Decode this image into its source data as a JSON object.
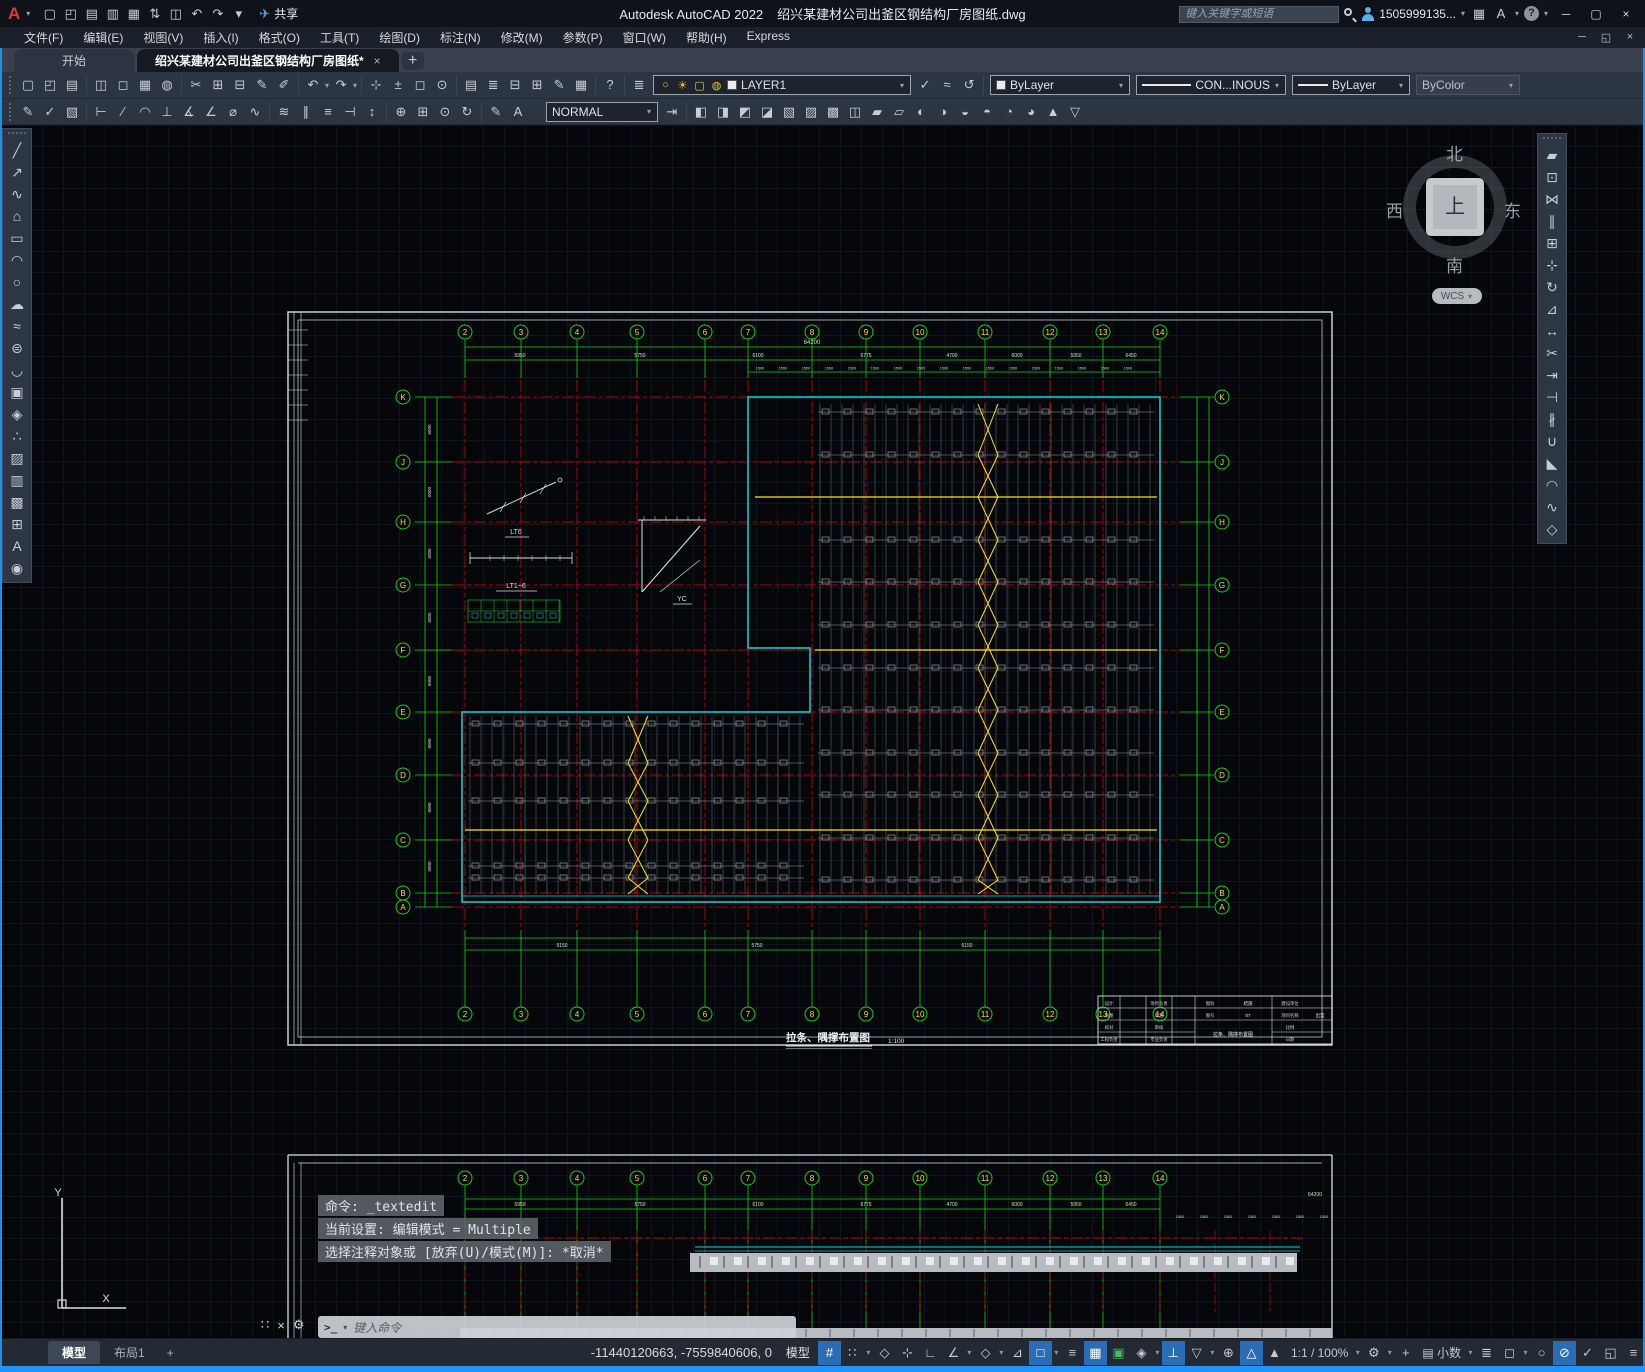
{
  "window": {
    "app_title": "Autodesk AutoCAD 2022",
    "doc_title": "绍兴某建材公司出釜区钢结构厂房图纸.dwg",
    "share_label": "共享",
    "search_placeholder": "键入关键字或短语",
    "account": "1505999135...",
    "help": "?"
  },
  "menu_items": [
    "文件(F)",
    "编辑(E)",
    "视图(V)",
    "插入(I)",
    "格式(O)",
    "工具(T)",
    "绘图(D)",
    "标注(N)",
    "修改(M)",
    "参数(P)",
    "窗口(W)",
    "帮助(H)",
    "Express"
  ],
  "file_tabs": {
    "start": "开始",
    "doc": "绍兴某建材公司出釜区钢结构厂房图纸*",
    "close": "×",
    "new_tab": "+"
  },
  "controls": {
    "layer": "LAYER1",
    "color": "ByLayer",
    "linetype": "CON...INOUS",
    "lineweight": "ByLayer",
    "plot_style": "ByColor",
    "dim_style": "NORMAL"
  },
  "qat_icons": [
    [
      "new-file",
      "▢"
    ],
    [
      "open-file",
      "◰"
    ],
    [
      "save",
      "▤"
    ],
    [
      "save-as",
      "▥"
    ],
    [
      "batch-plot",
      "▦"
    ],
    [
      "transfer",
      "⇅"
    ],
    [
      "print",
      "◫"
    ],
    [
      "undo",
      "↶"
    ],
    [
      "redo",
      "↷"
    ],
    [
      "customize",
      "▾"
    ]
  ],
  "toolbar1": [
    [
      [
        "new",
        "▢"
      ],
      [
        "open",
        "◰"
      ],
      [
        "save",
        "▤"
      ]
    ],
    [
      [
        "plot",
        "◫"
      ],
      [
        "plot-preview",
        "◻"
      ],
      [
        "publish",
        "▦"
      ],
      [
        "etransmit",
        "◍"
      ]
    ],
    [
      [
        "cut",
        "✂"
      ],
      [
        "copy-clip",
        "⊞"
      ],
      [
        "paste",
        "⊟"
      ],
      [
        "match-properties",
        "✎"
      ],
      [
        "block-editor",
        "✐"
      ]
    ],
    [
      [
        "undo",
        "↶",
        1
      ],
      [
        "redo",
        "↷",
        1
      ]
    ],
    [
      [
        "pan",
        "⊹"
      ],
      [
        "zoom-realtime",
        "±"
      ],
      [
        "zoom-window",
        "◻"
      ],
      [
        "zoom-previous",
        "⊙"
      ]
    ],
    [
      [
        "properties",
        "▤"
      ],
      [
        "layer-properties",
        "≣"
      ],
      [
        "tool-palettes",
        "⊟"
      ],
      [
        "sheet-set-manager",
        "⊞"
      ],
      [
        "markup",
        "✎"
      ],
      [
        "quick-calc",
        "▦"
      ]
    ],
    [
      [
        "help",
        "?"
      ]
    ]
  ],
  "layer_cluster": {
    "states_icon": [
      "layer-states",
      "≣"
    ],
    "combo_icons": [
      [
        "layer-on",
        "○"
      ],
      [
        "layer-sun",
        "☀"
      ],
      [
        "layer-frame",
        "▢"
      ],
      [
        "layer-lock",
        "◍"
      ]
    ],
    "after_icons": [
      [
        "make-current",
        "✓"
      ],
      [
        "match-layer",
        "≈"
      ],
      [
        "layer-previous",
        "↺"
      ]
    ]
  },
  "toolbar2a": [
    [
      [
        "edit-text",
        "✎"
      ],
      [
        "spell-check",
        "✓"
      ],
      [
        "annotation-monitor",
        "▧"
      ]
    ],
    [
      [
        "dim-linear",
        "⊢"
      ],
      [
        "dim-aligned",
        "∕"
      ],
      [
        "dim-arc-length",
        "◠"
      ],
      [
        "dim-ordinate",
        "⊥"
      ],
      [
        "dim-radius",
        "∡"
      ],
      [
        "dim-angular",
        "∠"
      ],
      [
        "dim-diameter",
        "⌀"
      ],
      [
        "dim-jogged",
        "∿"
      ]
    ],
    [
      [
        "dim-quick",
        "≋"
      ],
      [
        "dim-continue",
        "∥"
      ],
      [
        "dim-baseline",
        "≡"
      ],
      [
        "dim-break",
        "⊣"
      ],
      [
        "dim-adjust",
        "↕"
      ]
    ],
    [
      [
        "dim-center-mark",
        "⊕"
      ],
      [
        "tolerance",
        "⊞"
      ],
      [
        "dim-inspect",
        "⊙"
      ],
      [
        "dim-update",
        "↻"
      ]
    ],
    [
      [
        "dim-edit",
        "✎"
      ],
      [
        "dim-text-edit",
        "A"
      ]
    ]
  ],
  "toolbar2b": [
    [
      [
        "make-object-layer-current",
        "◧"
      ],
      [
        "layer-walk",
        "◨"
      ],
      [
        "layer-match",
        "◩"
      ],
      [
        "change-to-current-layer",
        "◪"
      ],
      [
        "layer-isolate",
        "▧"
      ],
      [
        "layer-unisolate",
        "▨"
      ],
      [
        "copy-to-new-layer",
        "▩"
      ],
      [
        "layer-freeze",
        "◫"
      ],
      [
        "layer-off",
        "▰"
      ],
      [
        "layer-on-all",
        "▱"
      ],
      [
        "layer-lock2",
        "◐"
      ],
      [
        "layer-unlock",
        "◑"
      ],
      [
        "layer-thaw-all",
        "◒"
      ],
      [
        "layer-merge",
        "◓"
      ],
      [
        "layer-delete",
        "◔"
      ],
      [
        "layer-combine",
        "◕"
      ],
      [
        "layer-up",
        "▲"
      ],
      [
        "layer-down",
        "▽"
      ]
    ]
  ],
  "draw_toolbar": [
    [
      "line",
      "╱"
    ],
    [
      "construction-line",
      "↗"
    ],
    [
      "polyline",
      "∿"
    ],
    [
      "polygon",
      "⌂"
    ],
    [
      "rectangle",
      "▭"
    ],
    [
      "arc",
      "◠"
    ],
    [
      "circle",
      "○"
    ],
    [
      "revision-cloud",
      "☁"
    ],
    [
      "spline",
      "≈"
    ],
    [
      "ellipse",
      "⊜"
    ],
    [
      "ellipse-arc",
      "◡"
    ],
    [
      "insert-block",
      "▣"
    ],
    [
      "create-block",
      "◈"
    ],
    [
      "point",
      "∴"
    ],
    [
      "hatch",
      "▨"
    ],
    [
      "gradient",
      "▥"
    ],
    [
      "region",
      "▩"
    ],
    [
      "table",
      "⊞"
    ],
    [
      "mtext",
      "A"
    ],
    [
      "point-style",
      "◉"
    ]
  ],
  "modify_toolbar": [
    [
      "erase",
      "▰"
    ],
    [
      "copy",
      "⊡"
    ],
    [
      "mirror",
      "⋈"
    ],
    [
      "offset",
      "∥"
    ],
    [
      "array",
      "⊞"
    ],
    [
      "move",
      "⊹"
    ],
    [
      "rotate",
      "↻"
    ],
    [
      "scale",
      "⊿"
    ],
    [
      "stretch",
      "↔"
    ],
    [
      "trim",
      "✂"
    ],
    [
      "extend",
      "⇥"
    ],
    [
      "break-at-point",
      "⊣"
    ],
    [
      "break",
      "∦"
    ],
    [
      "join",
      "∪"
    ],
    [
      "chamfer",
      "◣"
    ],
    [
      "fillet",
      "◠"
    ],
    [
      "blend-curves",
      "∿"
    ],
    [
      "explode",
      "◇"
    ]
  ],
  "viewcube": {
    "north": "北",
    "south": "南",
    "west": "西",
    "east": "东",
    "top": "上",
    "wcs": "WCS"
  },
  "command": {
    "lines": [
      "命令: _textedit",
      "当前设置: 编辑模式 = Multiple",
      "选择注释对象或 [放弃(U)/模式(M)]: *取消*"
    ],
    "input_placeholder": "键入命令"
  },
  "statusbar": {
    "coords": "-11440120663, -7559840606, 0",
    "model_btn": "模型",
    "annotation_scale": "1:1 / 100%",
    "units": "小数"
  },
  "status_toggles": [
    [
      "grid",
      "#",
      true,
      false,
      ""
    ],
    [
      "snap",
      "∷",
      false,
      true,
      ""
    ],
    [
      "infer-constraints",
      "◇",
      false,
      false,
      ""
    ],
    [
      "dynamic-input",
      "⊹",
      false,
      false,
      ""
    ],
    [
      "ortho",
      "∟",
      false,
      false,
      ""
    ],
    [
      "polar-tracking",
      "∠",
      false,
      true,
      ""
    ],
    [
      "isometric-drafting",
      "◇",
      false,
      true,
      ""
    ],
    [
      "object-snap-tracking",
      "⊿",
      false,
      false,
      ""
    ],
    [
      "object-snap",
      "□",
      true,
      true,
      ""
    ],
    [
      "lineweight-display",
      "≡",
      false,
      false,
      ""
    ],
    [
      "transparency",
      "▦",
      true,
      false,
      ""
    ],
    [
      "selection-cycling",
      "▣",
      false,
      false,
      "green"
    ],
    [
      "3d-object-snap",
      "◈",
      false,
      true,
      ""
    ],
    [
      "dynamic-ucs",
      "⊥",
      true,
      false,
      ""
    ],
    [
      "selection-filtering",
      "▽",
      false,
      true,
      ""
    ],
    [
      "gizmo",
      "⊕",
      false,
      false,
      ""
    ],
    [
      "annotation-visibility",
      "△",
      true,
      false,
      ""
    ],
    [
      "autoscale",
      "▲",
      false,
      false,
      ""
    ],
    [
      "annotation-scale",
      "1:1 / 100%",
      false,
      true,
      "text"
    ],
    [
      "workspace-switching",
      "⚙",
      false,
      true,
      ""
    ],
    [
      "isolate",
      "+",
      false,
      false,
      ""
    ],
    [
      "units",
      "小数",
      false,
      true,
      "units"
    ],
    [
      "quick-properties",
      "≣",
      false,
      false,
      ""
    ],
    [
      "lock-ui",
      "◻",
      false,
      true,
      ""
    ],
    [
      "isolate-objects",
      "○",
      false,
      false,
      ""
    ],
    [
      "hardware-acceleration",
      "⊘",
      true,
      false,
      ""
    ],
    [
      "trusted-autodesk",
      "✓",
      false,
      false,
      ""
    ],
    [
      "clean-screen",
      "◱",
      false,
      false,
      ""
    ],
    [
      "customization-menu",
      "≡",
      false,
      false,
      ""
    ]
  ],
  "model_tabs": {
    "model": "模型",
    "layout1": "布局1",
    "add": "+"
  },
  "drawing": {
    "title": "拉条、隅撑布置图",
    "scale_note": "1:100",
    "top_axes": [
      "2",
      "3",
      "4",
      "5",
      "6",
      "7",
      "8",
      "9",
      "10",
      "11",
      "12",
      "13",
      "14"
    ],
    "bottom_axes": [
      "2",
      "3",
      "4",
      "5",
      "6",
      "7",
      "8",
      "9",
      "10",
      "11",
      "12",
      "13",
      "14"
    ],
    "row_axes": [
      "K",
      "J",
      "H",
      "G",
      "F",
      "E",
      "D",
      "C",
      "B",
      "A"
    ],
    "top_overall_dim": "64200",
    "top_dims": [
      "5950",
      "5750",
      "6100",
      "6775",
      "4700",
      "6000",
      "5950",
      "6450"
    ],
    "spacing_dim": "1500",
    "bottom_dims": [
      "9150",
      "5750",
      "6150"
    ],
    "side_dims": [
      "6000",
      "6000",
      "6000",
      "6000",
      "6000",
      "6000",
      "6000",
      "6000"
    ],
    "detail_labels": [
      "LT6",
      "LT1~6",
      "YC"
    ],
    "titleblock": {
      "title": "拉条、隅撑布置图",
      "col1": [
        "设计",
        "制图",
        "校对",
        "工程负责"
      ],
      "col2": [
        "项目负责",
        "审定",
        "审核",
        "专业负责"
      ],
      "sheet": [
        [
          "图别",
          "结施"
        ],
        [
          "图号",
          "07"
        ]
      ],
      "right": [
        [
          "建设单位",
          ""
        ],
        [
          "项目名称",
          "出釜"
        ],
        [
          "比例",
          ""
        ],
        [
          "日期",
          ""
        ]
      ]
    }
  },
  "ucs": {
    "x": "X",
    "y": "Y"
  }
}
